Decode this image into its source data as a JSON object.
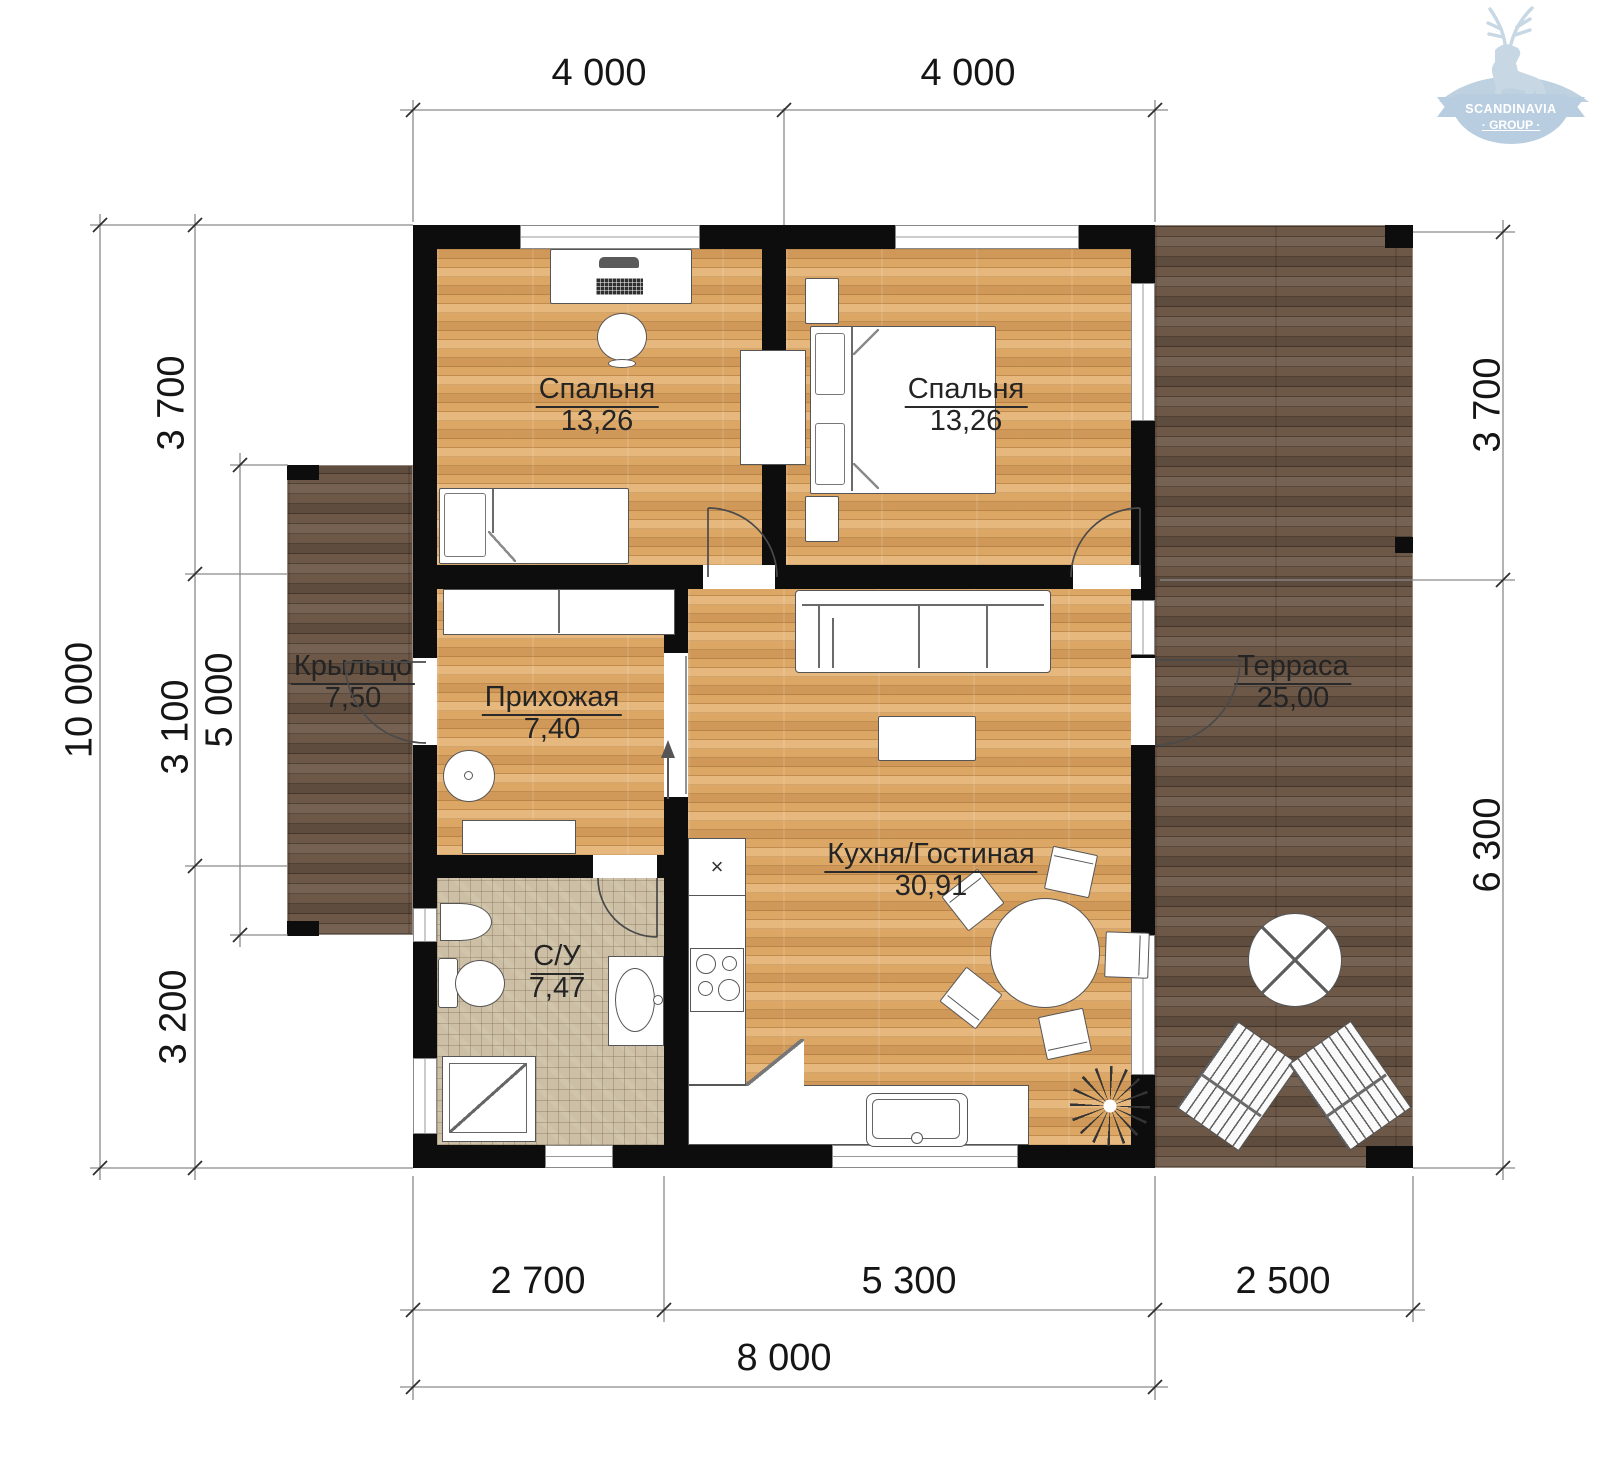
{
  "logo": {
    "line1": "SCANDINAVIA",
    "line2": "· GROUP ·"
  },
  "rooms": {
    "bedroom1": {
      "name": "Спальня",
      "area": "13,26"
    },
    "bedroom2": {
      "name": "Спальня",
      "area": "13,26"
    },
    "porch": {
      "name": "Крыльцо",
      "area": "7,50"
    },
    "hallway": {
      "name": "Прихожая",
      "area": "7,40"
    },
    "terrace": {
      "name": "Терраса",
      "area": "25,00"
    },
    "kitchen_living": {
      "name": "Кухня/Гостиная",
      "area": "30,91"
    },
    "bathroom": {
      "name": "С/У",
      "area": "7,47"
    }
  },
  "dimensions": {
    "top": [
      "4 000",
      "4 000"
    ],
    "bottom_segments": [
      "2 700",
      "5 300",
      "2 500"
    ],
    "bottom_total": "8 000",
    "left_total": "10 000",
    "left_segments": [
      "3 700",
      "3 100",
      "3 200"
    ],
    "left_inner": "5 000",
    "right_segments": [
      "3 700",
      "6 300"
    ]
  },
  "symbols": {
    "fridge_x": "×"
  },
  "colors": {
    "light_wood": "#dca665",
    "dark_wood": "#6d5848",
    "tile": "#ccbfa5",
    "wall": "#0d0d0d",
    "logo_blue": "#b9cde0",
    "dim_line": "#8a8a8a"
  }
}
